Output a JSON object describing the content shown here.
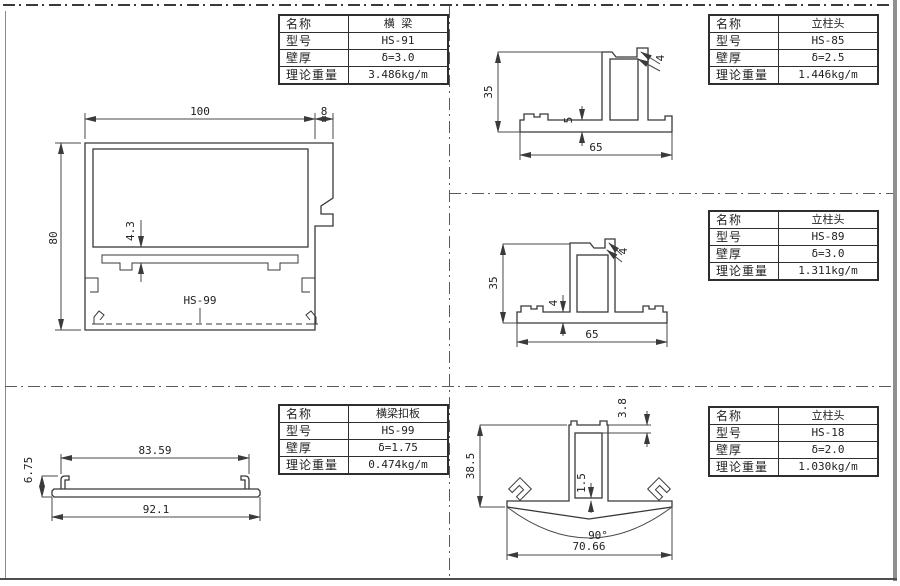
{
  "labels": [
    "名称",
    "型号",
    "壁厚",
    "理论重量"
  ],
  "tables": {
    "hs91": {
      "name": "横 梁",
      "model": "HS-91",
      "thickness": "δ=3.0",
      "weight": "3.486kg/m"
    },
    "hs85": {
      "name": "立柱头",
      "model": "HS-85",
      "thickness": "δ=2.5",
      "weight": "1.446kg/m"
    },
    "hs89": {
      "name": "立柱头",
      "model": "HS-89",
      "thickness": "δ=3.0",
      "weight": "1.311kg/m"
    },
    "hs18": {
      "name": "立柱头",
      "model": "HS-18",
      "thickness": "δ=2.0",
      "weight": "1.030kg/m"
    },
    "hs99": {
      "name": "横梁扣板",
      "model": "HS-99",
      "thickness": "δ=1.75",
      "weight": "0.474kg/m"
    }
  },
  "dims": {
    "hs91": {
      "width": "100",
      "flange": "8",
      "height": "80",
      "gap": "4.3",
      "ref": "HS-99"
    },
    "hs85": {
      "height": "35",
      "wall": "4",
      "base": "5",
      "width": "65"
    },
    "hs89": {
      "height": "35",
      "wall": "4",
      "base": "4",
      "width": "65"
    },
    "hs99": {
      "inner": "83.59",
      "height": "6.75",
      "width": "92.1"
    },
    "hs18": {
      "wall": "3.8",
      "height": "38.5",
      "web": "1.5",
      "angle": "90°",
      "width": "70.66"
    }
  }
}
